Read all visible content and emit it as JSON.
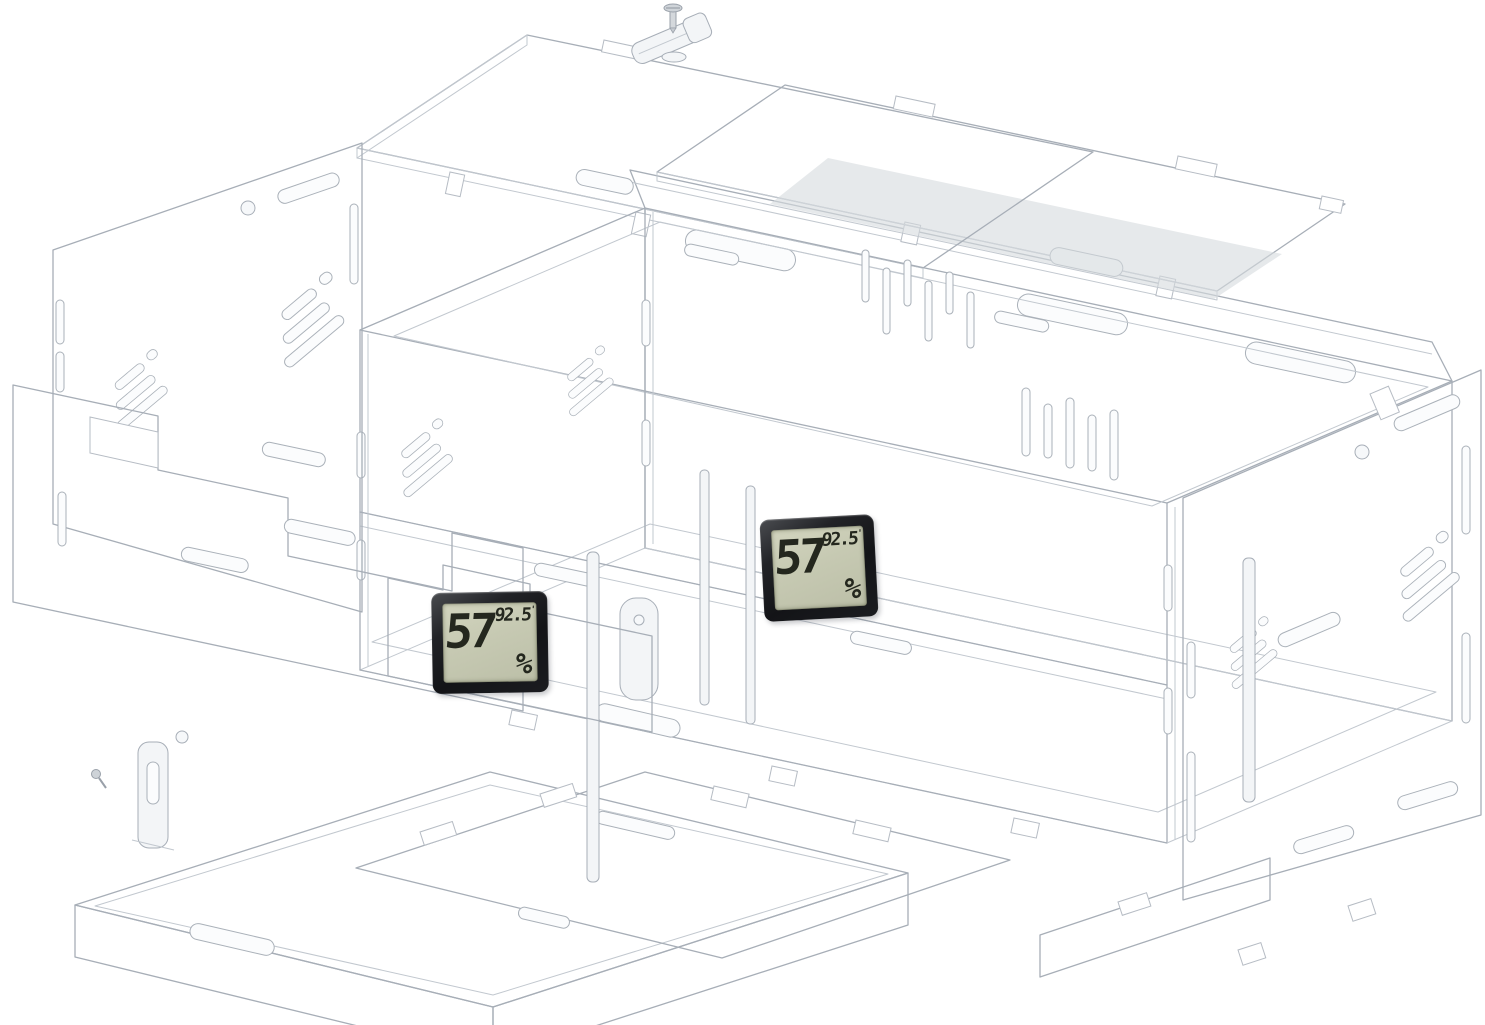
{
  "scene": {
    "type": "exploded-acrylic-enclosure-diagram",
    "background": "#ffffff",
    "line_color": "#a7aeb7",
    "panel_fill": "#eef0f3",
    "lid_fill": "#e2e5e9",
    "interior_floor_fill": "#c9cdd2"
  },
  "hygrometer_front": {
    "humidity": "57",
    "humidity_unit": "%",
    "temperature": "92.5",
    "degree_mark": "'"
  },
  "hygrometer_inside": {
    "humidity": "57",
    "humidity_unit": "%",
    "temperature": "92.5",
    "degree_mark": "'"
  },
  "lcd": {
    "frame_color": "#17181b",
    "screen_color": "#c6c9b2",
    "digit_color": "#24271e"
  },
  "parts": [
    "top-lid-left",
    "top-lid-right",
    "slide-latch",
    "mounting-screw",
    "back-panel",
    "main-box-frame",
    "left-side-panel",
    "front-door-panel",
    "right-side-panel",
    "bottom-tray",
    "floor-divider-panel",
    "divider-strips",
    "tray-latch",
    "tray-screw",
    "front-hygrometer",
    "inside-hygrometer"
  ]
}
